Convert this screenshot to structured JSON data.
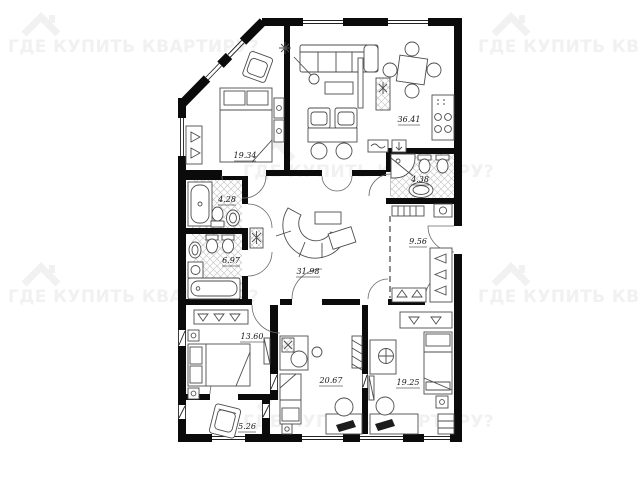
{
  "watermark": {
    "text": "ГДЕ КУПИТЬ КВАРТИРУ?",
    "icon": "house-icon",
    "color": "#f1f1f1"
  },
  "plan": {
    "units": "m2",
    "areas": {
      "bedroom_top_left": "19.34",
      "living_kitchen": "36.41",
      "bathroom_top_right": "4.38",
      "shower_room_left": "4.28",
      "bathroom_left": "6.97",
      "hallway": "31.98",
      "corridor": "9.56",
      "bedroom_bottom_left": "13.60",
      "room_bottom_middle": "20.67",
      "bedroom_bottom_right": "19.25",
      "balcony": "5.26"
    }
  }
}
